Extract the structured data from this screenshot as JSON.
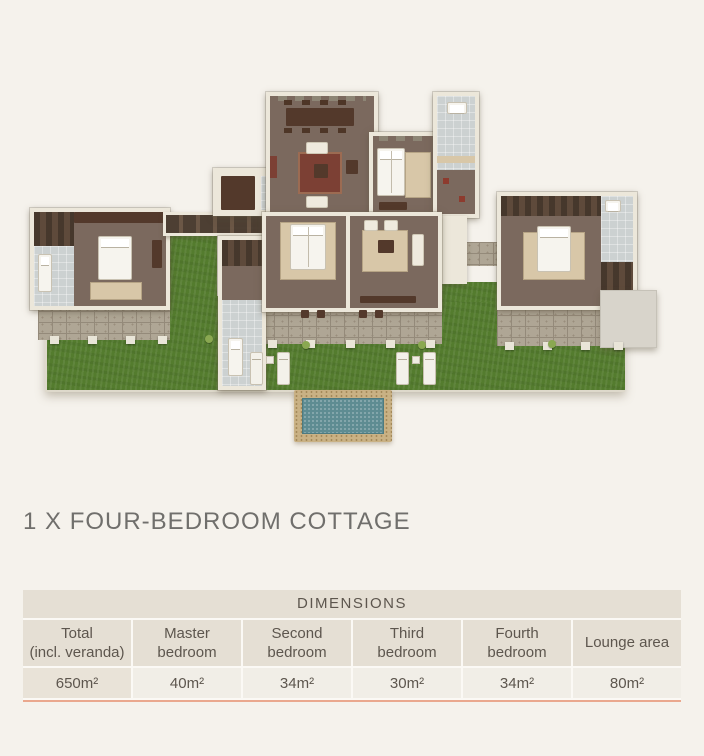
{
  "title": "1 X FOUR-BEDROOM COTTAGE",
  "floorplan": {
    "alt": "3D aerial floor plan of a four-bedroom cottage: central living and dining room, four bedroom suites with bathrooms, covered walkways, stone verandas, lawn with sun loungers and a plunge pool"
  },
  "table": {
    "header": "DIMENSIONS",
    "columns": [
      {
        "label": "Total\n(incl. veranda)",
        "value": "650m²"
      },
      {
        "label": "Master\nbedroom",
        "value": "40m²"
      },
      {
        "label": "Second\nbedroom",
        "value": "34m²"
      },
      {
        "label": "Third\nbedroom",
        "value": "30m²"
      },
      {
        "label": "Fourth\nbedroom",
        "value": "34m²"
      },
      {
        "label": "Lounge area",
        "value": "80m²"
      }
    ]
  },
  "colors": {
    "page_bg": "#f5f2ec",
    "gap_white": "#fbf9f5",
    "title_text": "#706f6c",
    "table_text": "#5d564e",
    "cell_beige": "#e5dfd4",
    "cell_beige_light": "#e9e3d8",
    "cell_light": "#f1eee7",
    "accent_line": "#eaa88e",
    "lawn": "#547c2e",
    "wall": "#ece7da",
    "floor_brown": "#7b695e",
    "floor_beige": "#d9c9ae",
    "floor_bath": "#ccd1d1",
    "stone": "#afa695",
    "stone_line": "#948a7a",
    "dark_wood": "#53392b",
    "closet_brown": "#5e4a3b",
    "cream_furn": "#efeade",
    "rug_beige": "#d8c7a8",
    "rug_red": "#7c4034",
    "pool_deck": "#c9b184",
    "pool_water": "#5e8c92",
    "roof_gray": "#d8d4cb",
    "bed_white": "#f6f4ee"
  }
}
